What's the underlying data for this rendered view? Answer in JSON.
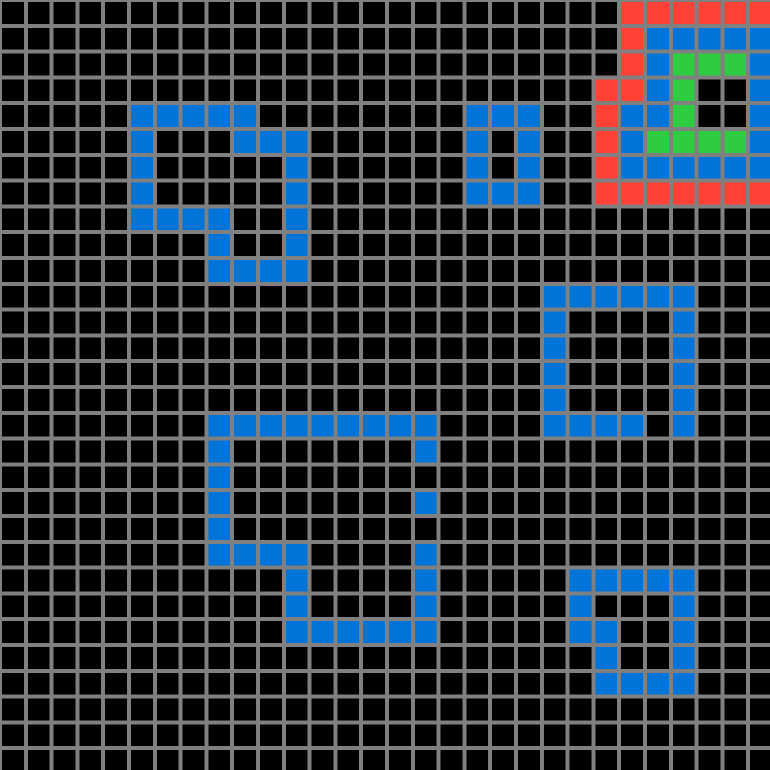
{
  "board": {
    "width_px": 770,
    "height_px": 770,
    "cols": 30,
    "rows": 30,
    "cell_pitch_px": 25.8,
    "grid_line_width_px": 4,
    "background_color": "#000000",
    "grid_line_color": "#808080"
  },
  "palette": {
    "blue": "#0074D9",
    "red": "#FF4136",
    "green": "#2ECC40"
  },
  "shapes": [
    {
      "name": "top-left-overlapping-squares",
      "color": "blue",
      "cells": [
        [
          4,
          5
        ],
        [
          4,
          6
        ],
        [
          4,
          7
        ],
        [
          4,
          8
        ],
        [
          4,
          9
        ],
        [
          5,
          5
        ],
        [
          5,
          9
        ],
        [
          5,
          10
        ],
        [
          5,
          11
        ],
        [
          6,
          5
        ],
        [
          6,
          11
        ],
        [
          7,
          5
        ],
        [
          7,
          11
        ],
        [
          8,
          5
        ],
        [
          8,
          6
        ],
        [
          8,
          7
        ],
        [
          8,
          8
        ],
        [
          8,
          11
        ],
        [
          9,
          8
        ],
        [
          9,
          11
        ],
        [
          10,
          8
        ],
        [
          10,
          9
        ],
        [
          10,
          10
        ],
        [
          10,
          11
        ]
      ]
    },
    {
      "name": "small-ring-top-middle",
      "color": "blue",
      "cells": [
        [
          4,
          18
        ],
        [
          4,
          19
        ],
        [
          4,
          20
        ],
        [
          5,
          18
        ],
        [
          5,
          20
        ],
        [
          6,
          18
        ],
        [
          6,
          20
        ],
        [
          7,
          18
        ],
        [
          7,
          19
        ],
        [
          7,
          20
        ]
      ]
    },
    {
      "name": "mid-right-square-outline",
      "color": "blue",
      "cells": [
        [
          11,
          21
        ],
        [
          11,
          22
        ],
        [
          11,
          23
        ],
        [
          11,
          24
        ],
        [
          11,
          25
        ],
        [
          11,
          26
        ],
        [
          12,
          21
        ],
        [
          12,
          26
        ],
        [
          13,
          21
        ],
        [
          13,
          26
        ],
        [
          14,
          21
        ],
        [
          14,
          26
        ],
        [
          15,
          21
        ],
        [
          15,
          26
        ],
        [
          16,
          21
        ],
        [
          16,
          22
        ],
        [
          16,
          23
        ],
        [
          16,
          24
        ],
        [
          16,
          26
        ]
      ]
    },
    {
      "name": "center-large-overlapping-squares",
      "color": "blue",
      "cells": [
        [
          16,
          8
        ],
        [
          16,
          9
        ],
        [
          16,
          10
        ],
        [
          16,
          11
        ],
        [
          16,
          12
        ],
        [
          16,
          13
        ],
        [
          16,
          14
        ],
        [
          16,
          15
        ],
        [
          16,
          16
        ],
        [
          17,
          8
        ],
        [
          17,
          16
        ],
        [
          18,
          8
        ],
        [
          19,
          8
        ],
        [
          19,
          16
        ],
        [
          20,
          8
        ],
        [
          21,
          8
        ],
        [
          21,
          9
        ],
        [
          21,
          10
        ],
        [
          21,
          11
        ],
        [
          21,
          16
        ],
        [
          22,
          11
        ],
        [
          22,
          16
        ],
        [
          23,
          11
        ],
        [
          23,
          16
        ],
        [
          24,
          11
        ],
        [
          24,
          12
        ],
        [
          24,
          13
        ],
        [
          24,
          14
        ],
        [
          24,
          15
        ],
        [
          24,
          16
        ]
      ]
    },
    {
      "name": "bottom-right-overlapping-squares",
      "color": "blue",
      "cells": [
        [
          22,
          22
        ],
        [
          22,
          23
        ],
        [
          22,
          24
        ],
        [
          22,
          25
        ],
        [
          22,
          26
        ],
        [
          23,
          22
        ],
        [
          23,
          26
        ],
        [
          24,
          22
        ],
        [
          24,
          23
        ],
        [
          24,
          26
        ],
        [
          25,
          23
        ],
        [
          25,
          26
        ],
        [
          26,
          23
        ],
        [
          26,
          24
        ],
        [
          26,
          25
        ],
        [
          26,
          26
        ]
      ]
    },
    {
      "name": "top-right-red-outline",
      "color": "red",
      "cells": [
        [
          0,
          24
        ],
        [
          0,
          25
        ],
        [
          0,
          26
        ],
        [
          0,
          27
        ],
        [
          0,
          28
        ],
        [
          0,
          29
        ],
        [
          1,
          24
        ],
        [
          2,
          24
        ],
        [
          3,
          23
        ],
        [
          3,
          24
        ],
        [
          4,
          23
        ],
        [
          5,
          23
        ],
        [
          6,
          23
        ],
        [
          7,
          23
        ],
        [
          7,
          24
        ],
        [
          7,
          25
        ],
        [
          7,
          26
        ],
        [
          7,
          27
        ],
        [
          7,
          28
        ],
        [
          7,
          29
        ]
      ]
    },
    {
      "name": "top-right-blue-ring",
      "color": "blue",
      "cells": [
        [
          1,
          25
        ],
        [
          1,
          26
        ],
        [
          1,
          27
        ],
        [
          1,
          28
        ],
        [
          1,
          29
        ],
        [
          2,
          25
        ],
        [
          2,
          29
        ],
        [
          3,
          25
        ],
        [
          3,
          29
        ],
        [
          4,
          24
        ],
        [
          4,
          25
        ],
        [
          4,
          29
        ],
        [
          5,
          24
        ],
        [
          5,
          29
        ],
        [
          6,
          24
        ],
        [
          6,
          25
        ],
        [
          6,
          26
        ],
        [
          6,
          27
        ],
        [
          6,
          28
        ],
        [
          6,
          29
        ]
      ]
    },
    {
      "name": "top-right-green-inner",
      "color": "green",
      "cells": [
        [
          2,
          26
        ],
        [
          2,
          27
        ],
        [
          2,
          28
        ],
        [
          3,
          26
        ],
        [
          4,
          26
        ],
        [
          5,
          25
        ],
        [
          5,
          26
        ],
        [
          5,
          27
        ],
        [
          5,
          28
        ]
      ]
    }
  ]
}
